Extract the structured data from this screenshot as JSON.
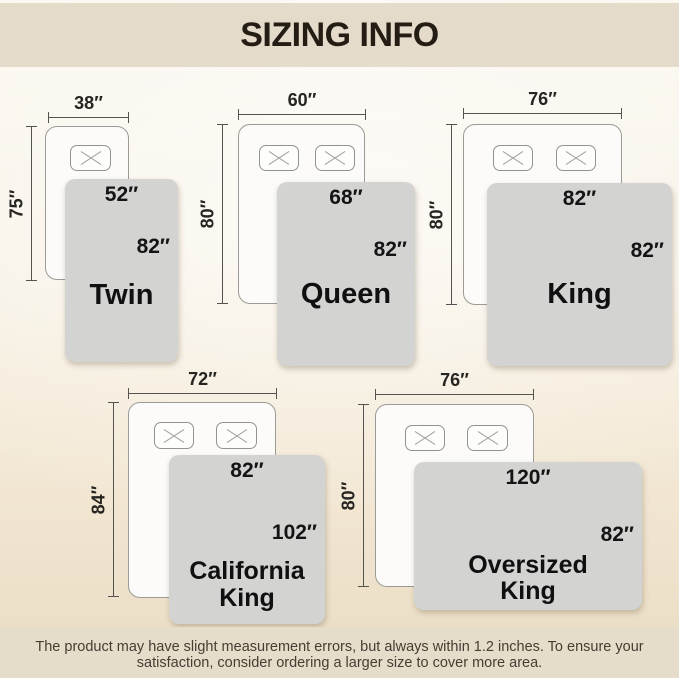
{
  "title": "SIZING INFO",
  "note": {
    "line1": "The product may have slight measurement errors, but always within 1.2 inches. To ensure your",
    "line2": "satisfaction, consider ordering a larger size to cover more area."
  },
  "sizes": [
    {
      "name": "Twin",
      "bed_width": "38″",
      "bed_length": "75″",
      "blanket_width": "52″",
      "blanket_length": "82″",
      "pillow_count": 1
    },
    {
      "name": "Queen",
      "bed_width": "60″",
      "bed_length": "80″",
      "blanket_width": "68″",
      "blanket_length": "82″",
      "pillow_count": 2
    },
    {
      "name": "King",
      "bed_width": "76″",
      "bed_length": "80″",
      "blanket_width": "82″",
      "blanket_length": "82″",
      "pillow_count": 2
    },
    {
      "name": "California King",
      "bed_width": "72″",
      "bed_length": "84″",
      "blanket_width": "82″",
      "blanket_length": "102″",
      "pillow_count": 2
    },
    {
      "name": "Oversized King",
      "bed_width": "76″",
      "bed_length": "80″",
      "blanket_width": "120″",
      "blanket_length": "82″",
      "pillow_count": 2
    }
  ],
  "colors": {
    "band": "#e4dbcb",
    "background_top": "#fbf8f1",
    "background_bottom": "#eadcc4",
    "blanket": "#d3d3d2",
    "bed_fill": "#fcfbf9",
    "bed_outline": "#9a9a97",
    "dimension_line": "#55534f",
    "title_text": "#241d14",
    "note_text": "#453e33"
  }
}
